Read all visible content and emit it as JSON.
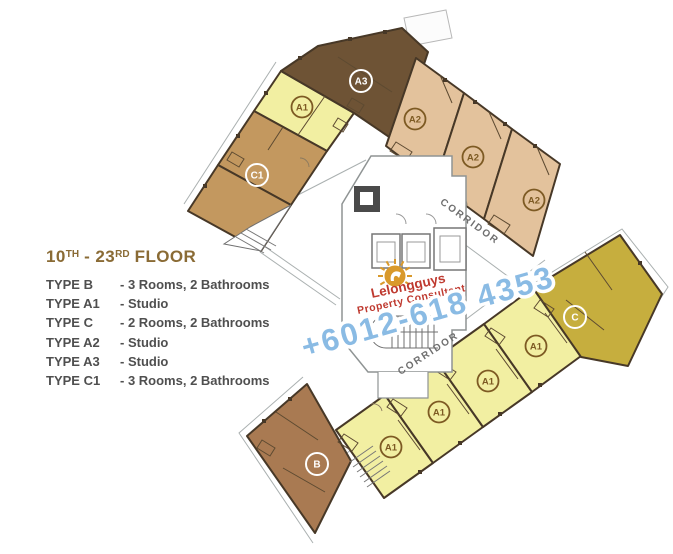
{
  "legend": {
    "title": {
      "n1": "10",
      "s1": "TH",
      "sep": " - ",
      "n2": "23",
      "s2": "RD",
      "rest": " FLOOR"
    },
    "rows": [
      {
        "type": "TYPE B",
        "desc": "- 3 Rooms, 2 Bathrooms"
      },
      {
        "type": "TYPE A1",
        "desc": "- Studio"
      },
      {
        "type": "TYPE C",
        "desc": "- 2 Rooms, 2 Bathrooms"
      },
      {
        "type": "TYPE A2",
        "desc": "- Studio"
      },
      {
        "type": "TYPE A3",
        "desc": "- Studio"
      },
      {
        "type": "TYPE C1",
        "desc": "- 3 Rooms, 2 Bathrooms"
      }
    ]
  },
  "plan": {
    "corridor_upper": "CORRIDOR",
    "corridor_lower": "CORRIDOR",
    "units": {
      "a1_left": "A1",
      "a3": "A3",
      "c1": "C1",
      "a2_1": "A2",
      "a2_2": "A2",
      "a2_3": "A2",
      "a1_r1": "A1",
      "a1_r2": "A1",
      "a1_r3": "A1",
      "a1_r4": "A1",
      "c": "C",
      "b": "B"
    }
  },
  "watermark": {
    "brand": "Lelongguys",
    "tagline": "Property Consultant",
    "phone": "+6012-618 4353"
  },
  "colors": {
    "unit_a1": "#f2efa2",
    "unit_a2": "#e3c29c",
    "unit_a3": "#6e5335",
    "unit_c1": "#c3985f",
    "unit_c": "#c6ae3e",
    "unit_b": "#a97a52",
    "wall": "#473827",
    "label_brown": "#7d5a23",
    "label_white": "#ffffff",
    "corridor_text": "#6f6f6f",
    "legend_title": "#8a6b35",
    "legend_text": "#4f4f4f",
    "brand_red": "#bf3a30",
    "brand_gold": "#d9992b",
    "phone_blue": "#8abbe4",
    "core_gray": "#8f9494"
  }
}
